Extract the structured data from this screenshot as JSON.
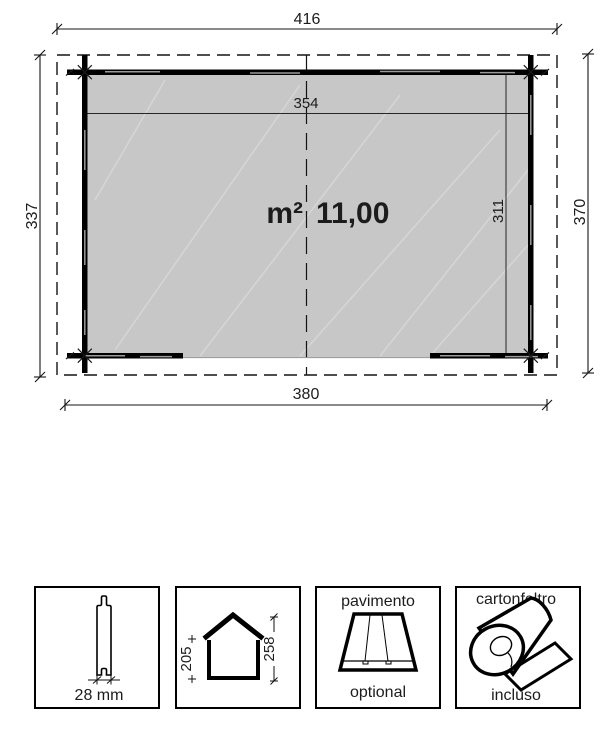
{
  "plan": {
    "roof_width_label": "416",
    "base_width_label": "380",
    "left_depth_label": "337",
    "right_depth_label": "370",
    "inner_width_label": "354",
    "inner_depth_label": "311",
    "area_unit": "m²",
    "area_value": "11,00",
    "colors": {
      "floor_fill": "#c7c7c7",
      "wall": "#000000",
      "line": "#1a1a1a"
    }
  },
  "legend": {
    "wall_profile": {
      "thickness_label": "28 mm"
    },
    "elevation": {
      "wall_height_label": "205",
      "ridge_height_label": "258"
    },
    "floor_panel": {
      "title": "pavimento",
      "availability": "optional"
    },
    "roof_felt": {
      "title": "cartonfeltro",
      "availability": "incluso"
    }
  }
}
